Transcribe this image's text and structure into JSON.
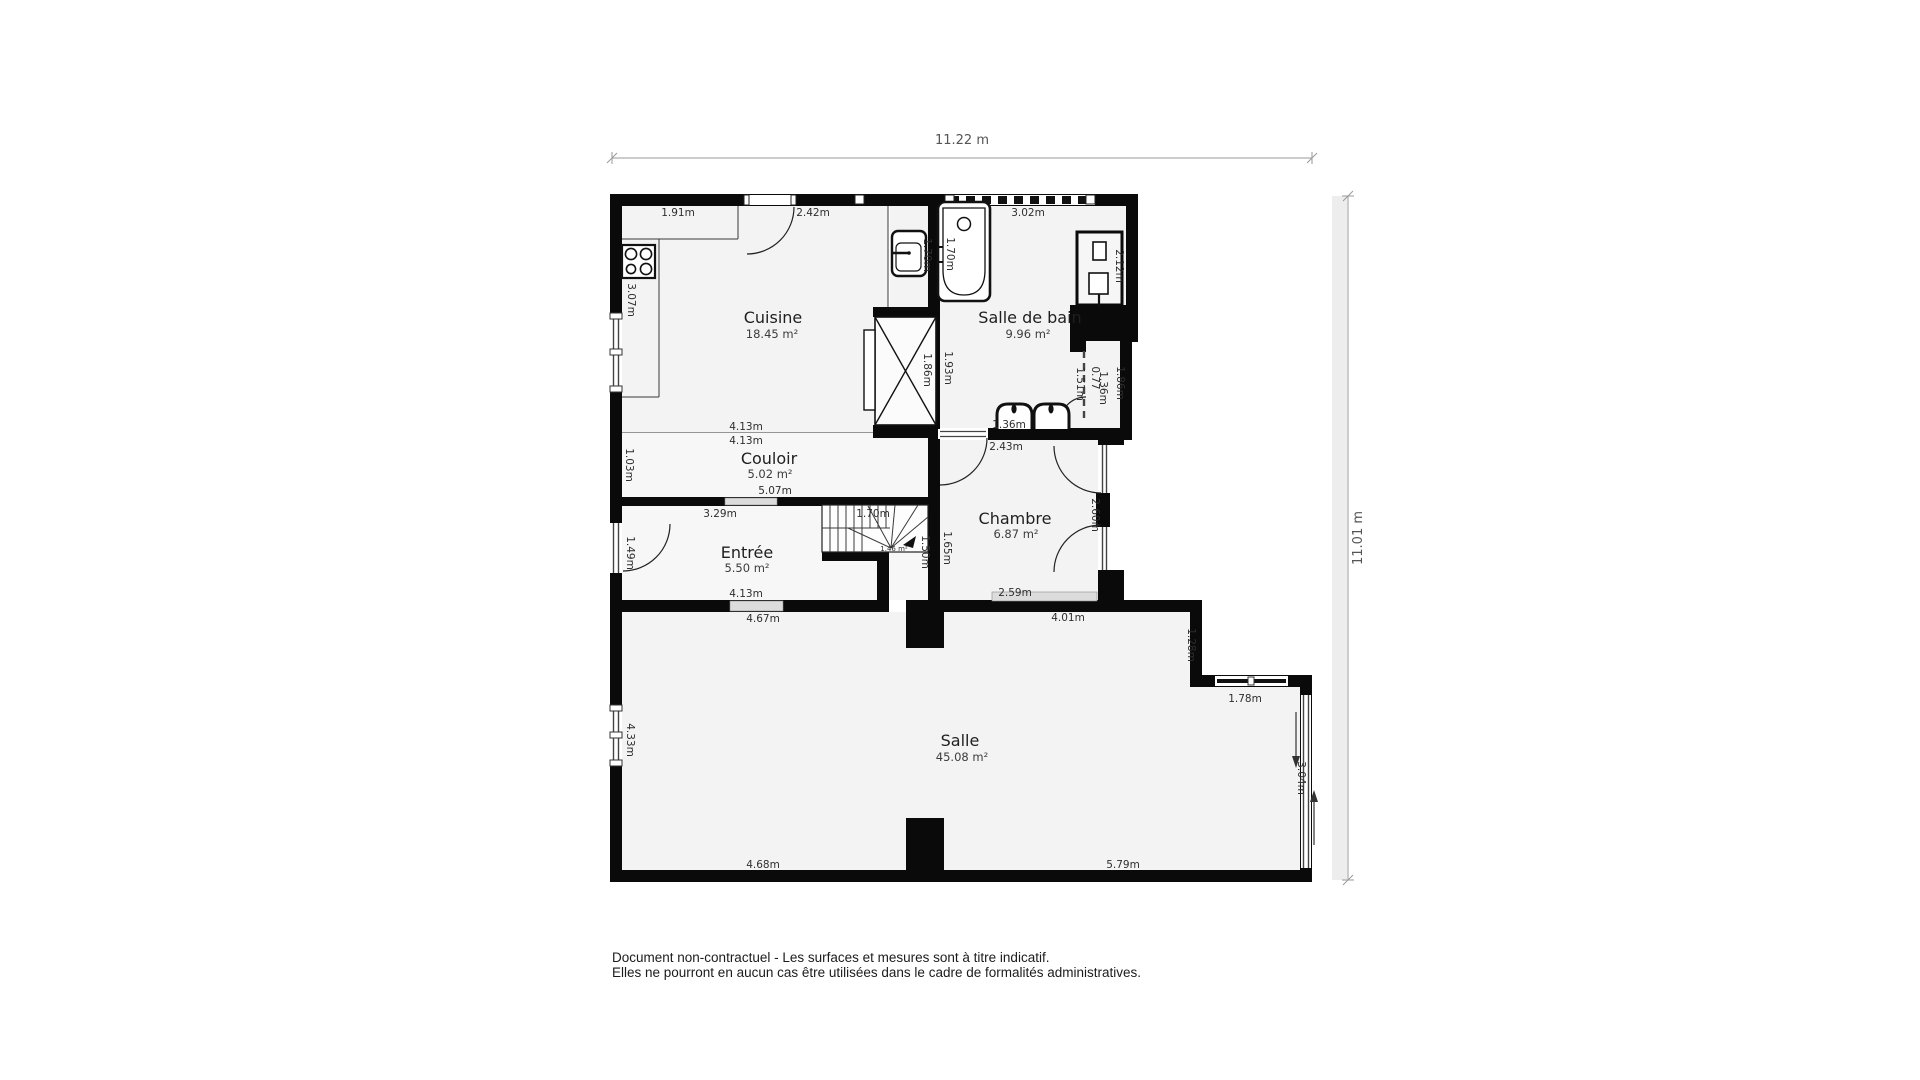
{
  "plan": {
    "rooms": [
      {
        "name": "Cuisine",
        "area": "18.45 m²"
      },
      {
        "name": "Salle de bain",
        "area": "9.96 m²"
      },
      {
        "name": "Couloir",
        "area": "5.02 m²"
      },
      {
        "name": "Chambre",
        "area": "6.87 m²"
      },
      {
        "name": "Entrée",
        "area": "5.50 m²"
      },
      {
        "name": "Salle",
        "area": "45.08 m²"
      }
    ],
    "overall": {
      "width_label": "11.22 m",
      "height_label": "11.01 m"
    },
    "dims": {
      "c_top_l": "1.91m",
      "c_top_r": "2.42m",
      "c_left": "3.07m",
      "c_bot1": "4.13m",
      "c_bot2": "4.13m",
      "hall_left": "1.03m",
      "hall_bot": "5.07m",
      "ent_top": "3.29m",
      "ent_left": "1.49m",
      "ent_bot": "4.13m",
      "salle_top_l": "4.67m",
      "salle_top_r": "4.01m",
      "salle_bot_l": "4.68m",
      "salle_bot_r": "5.79m",
      "salle_left": "4.33m",
      "salle_right": "3.04m",
      "step_v": "1.28m",
      "step_h": "1.78m",
      "bath_top": "3.02m",
      "bath_left": "1.93m",
      "bath_sink": "1.36m",
      "nook": "1.70m",
      "tub": "1.70m",
      "shaft": "1.86m",
      "washer": "2.12m",
      "wc_a": "1.51m",
      "wc_b": "0.77",
      "wc_c": "1.36m",
      "wc_right": "1.86m",
      "ch_top": "2.43m",
      "ch_left": "1.65m",
      "ch_right": "2.60m",
      "ch_bot": "2.59m",
      "st_w": "1.70m",
      "st_d": "1.50m",
      "st_area": "1.46 m²"
    },
    "fixtures": [
      "stove-icon",
      "bathtub-icon",
      "hand-basin-icon",
      "washer-icon",
      "double-sink-icon",
      "stairs-icon",
      "duct-icon"
    ]
  },
  "footer": {
    "line1": "Document non-contractuel - Les surfaces et mesures sont à titre indicatif.",
    "line2": "Elles ne pourront en aucun cas être utilisées dans le cadre de formalités administratives."
  }
}
